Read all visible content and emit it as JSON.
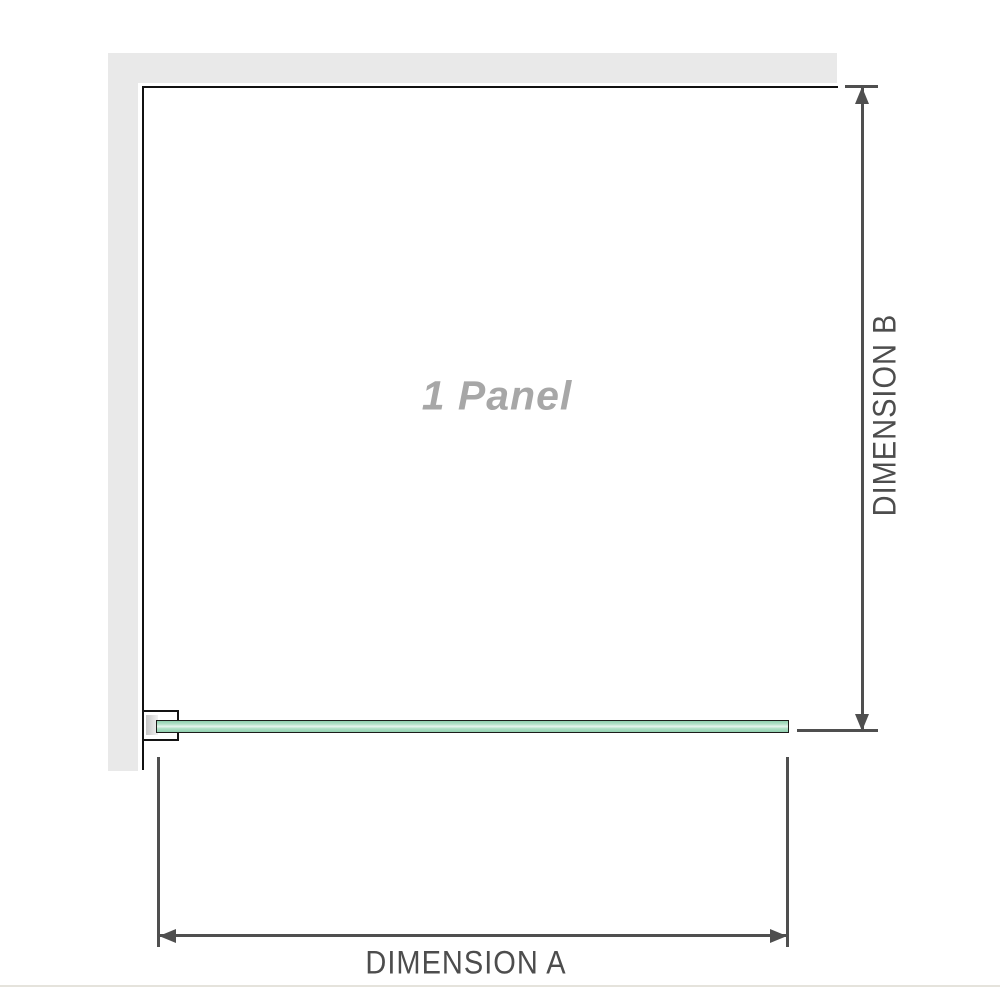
{
  "diagram": {
    "panel_label": "1 Panel",
    "panel_count": 1,
    "dimension_a": {
      "label": "DIMENSION A",
      "axis": "horizontal"
    },
    "dimension_b": {
      "label": "DIMENSION B",
      "axis": "vertical"
    },
    "colors": {
      "wall_fill": "#e9e9e9",
      "wall_edge": "#111111",
      "dimension_line": "#4f4f4f",
      "dimension_text": "#4d4d4d",
      "panel_label_text": "#a7a7a7",
      "glass_border": "#1c1c1a",
      "glass_green": "#9ad5b6",
      "glass_highlight": "#e7f5ee",
      "bracket_border": "#141414",
      "bracket_fill": "#ffffff",
      "bracket_shade": "#c6c6c6",
      "footer_rule": "#e5e3dc"
    }
  }
}
